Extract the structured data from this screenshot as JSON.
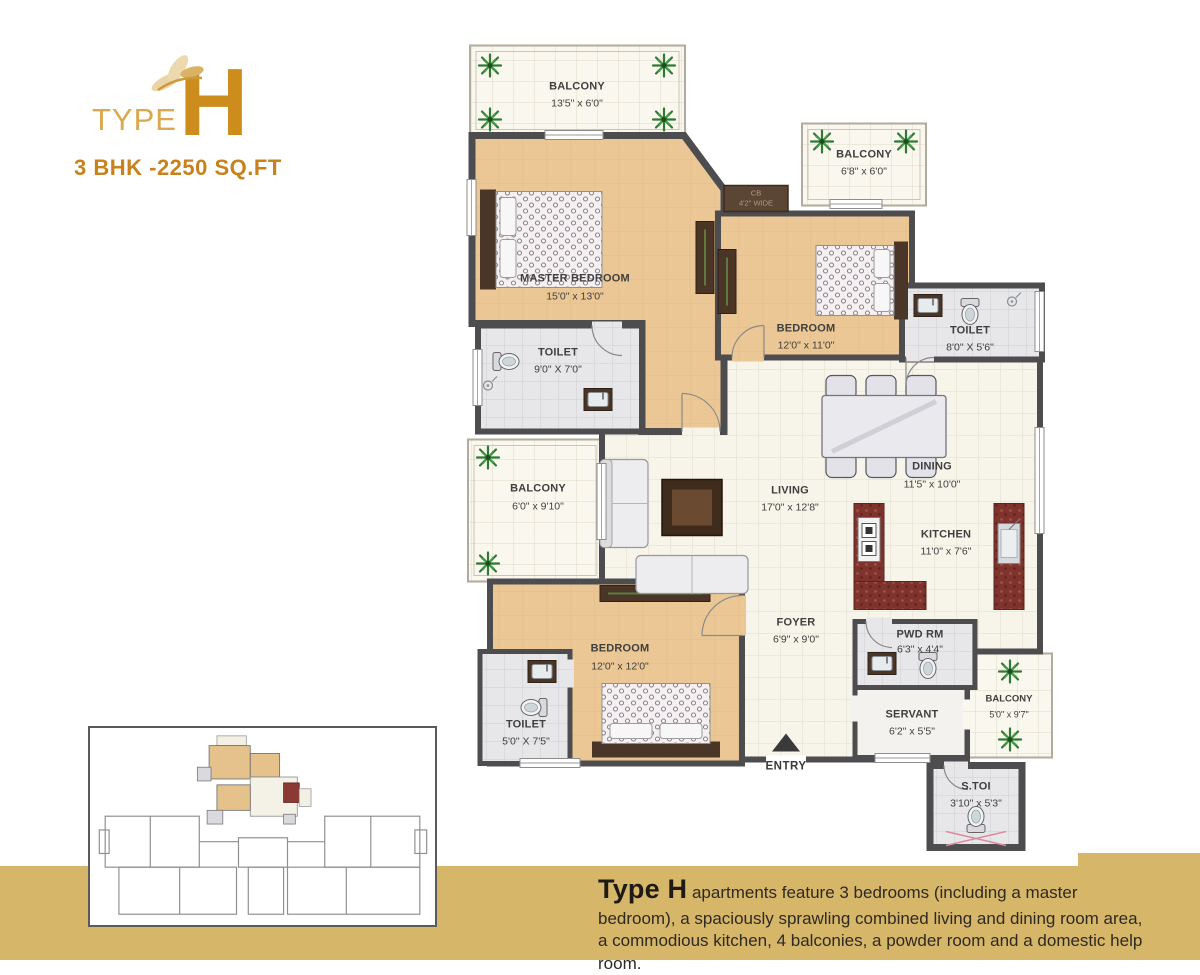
{
  "logo": {
    "type_label": "TYPE",
    "letter": "H",
    "subtitle": "3 BHK -2250 SQ.FT"
  },
  "floorplan": {
    "rooms": [
      {
        "id": "balcony-top",
        "name": "BALCONY",
        "dims": "13'5\" x 6'0\""
      },
      {
        "id": "master-bedroom",
        "name": "MASTER BEDROOM",
        "dims": "15'0\" x 13'0\""
      },
      {
        "id": "balcony-upper-right",
        "name": "BALCONY",
        "dims": "6'8\" x 6'0\""
      },
      {
        "id": "bedroom-2",
        "name": "BEDROOM",
        "dims": "12'0\" x 11'0\""
      },
      {
        "id": "toilet-2",
        "name": "TOILET",
        "dims": "8'0\" X 5'6\""
      },
      {
        "id": "toilet-master",
        "name": "TOILET",
        "dims": "9'0\" X 7'0\""
      },
      {
        "id": "balcony-left",
        "name": "BALCONY",
        "dims": "6'0\" x 9'10\""
      },
      {
        "id": "living",
        "name": "LIVING",
        "dims": "17'0\" x 12'8\""
      },
      {
        "id": "dining",
        "name": "DINING",
        "dims": "11'5\" x 10'0\""
      },
      {
        "id": "kitchen",
        "name": "KITCHEN",
        "dims": "11'0\" x 7'6\""
      },
      {
        "id": "bedroom-3",
        "name": "BEDROOM",
        "dims": "12'0\" x 12'0\""
      },
      {
        "id": "toilet-3",
        "name": "TOILET",
        "dims": "5'0\" X 7'5\""
      },
      {
        "id": "foyer",
        "name": "FOYER",
        "dims": "6'9\" x 9'0\""
      },
      {
        "id": "powder-room",
        "name": "PWD RM",
        "dims": "6'3\" x 4'4\""
      },
      {
        "id": "servant",
        "name": "SERVANT",
        "dims": "6'2\" x 5'5\""
      },
      {
        "id": "balcony-right",
        "name": "BALCONY",
        "dims": "5'0\" x 9'7\""
      },
      {
        "id": "servant-toilet",
        "name": "S.TOI",
        "dims": "3'10\" x 5'3\""
      }
    ],
    "cupboard": {
      "label": "CB",
      "dims": "4'2\" WIDE"
    },
    "entry_label": "ENTRY"
  },
  "description": {
    "title": "Type H",
    "body": "apartments feature 3 bedrooms (including a master bedroom), a spaciously sprawling combined living and dining room area, a commodious kitchen, 4 balconies, a powder room and a domestic help room."
  },
  "colors": {
    "banner": "#d6b669",
    "accent_gold": "#cd8d1d",
    "wall": "#4d4c4e",
    "floor_tan": "#ebc795"
  }
}
